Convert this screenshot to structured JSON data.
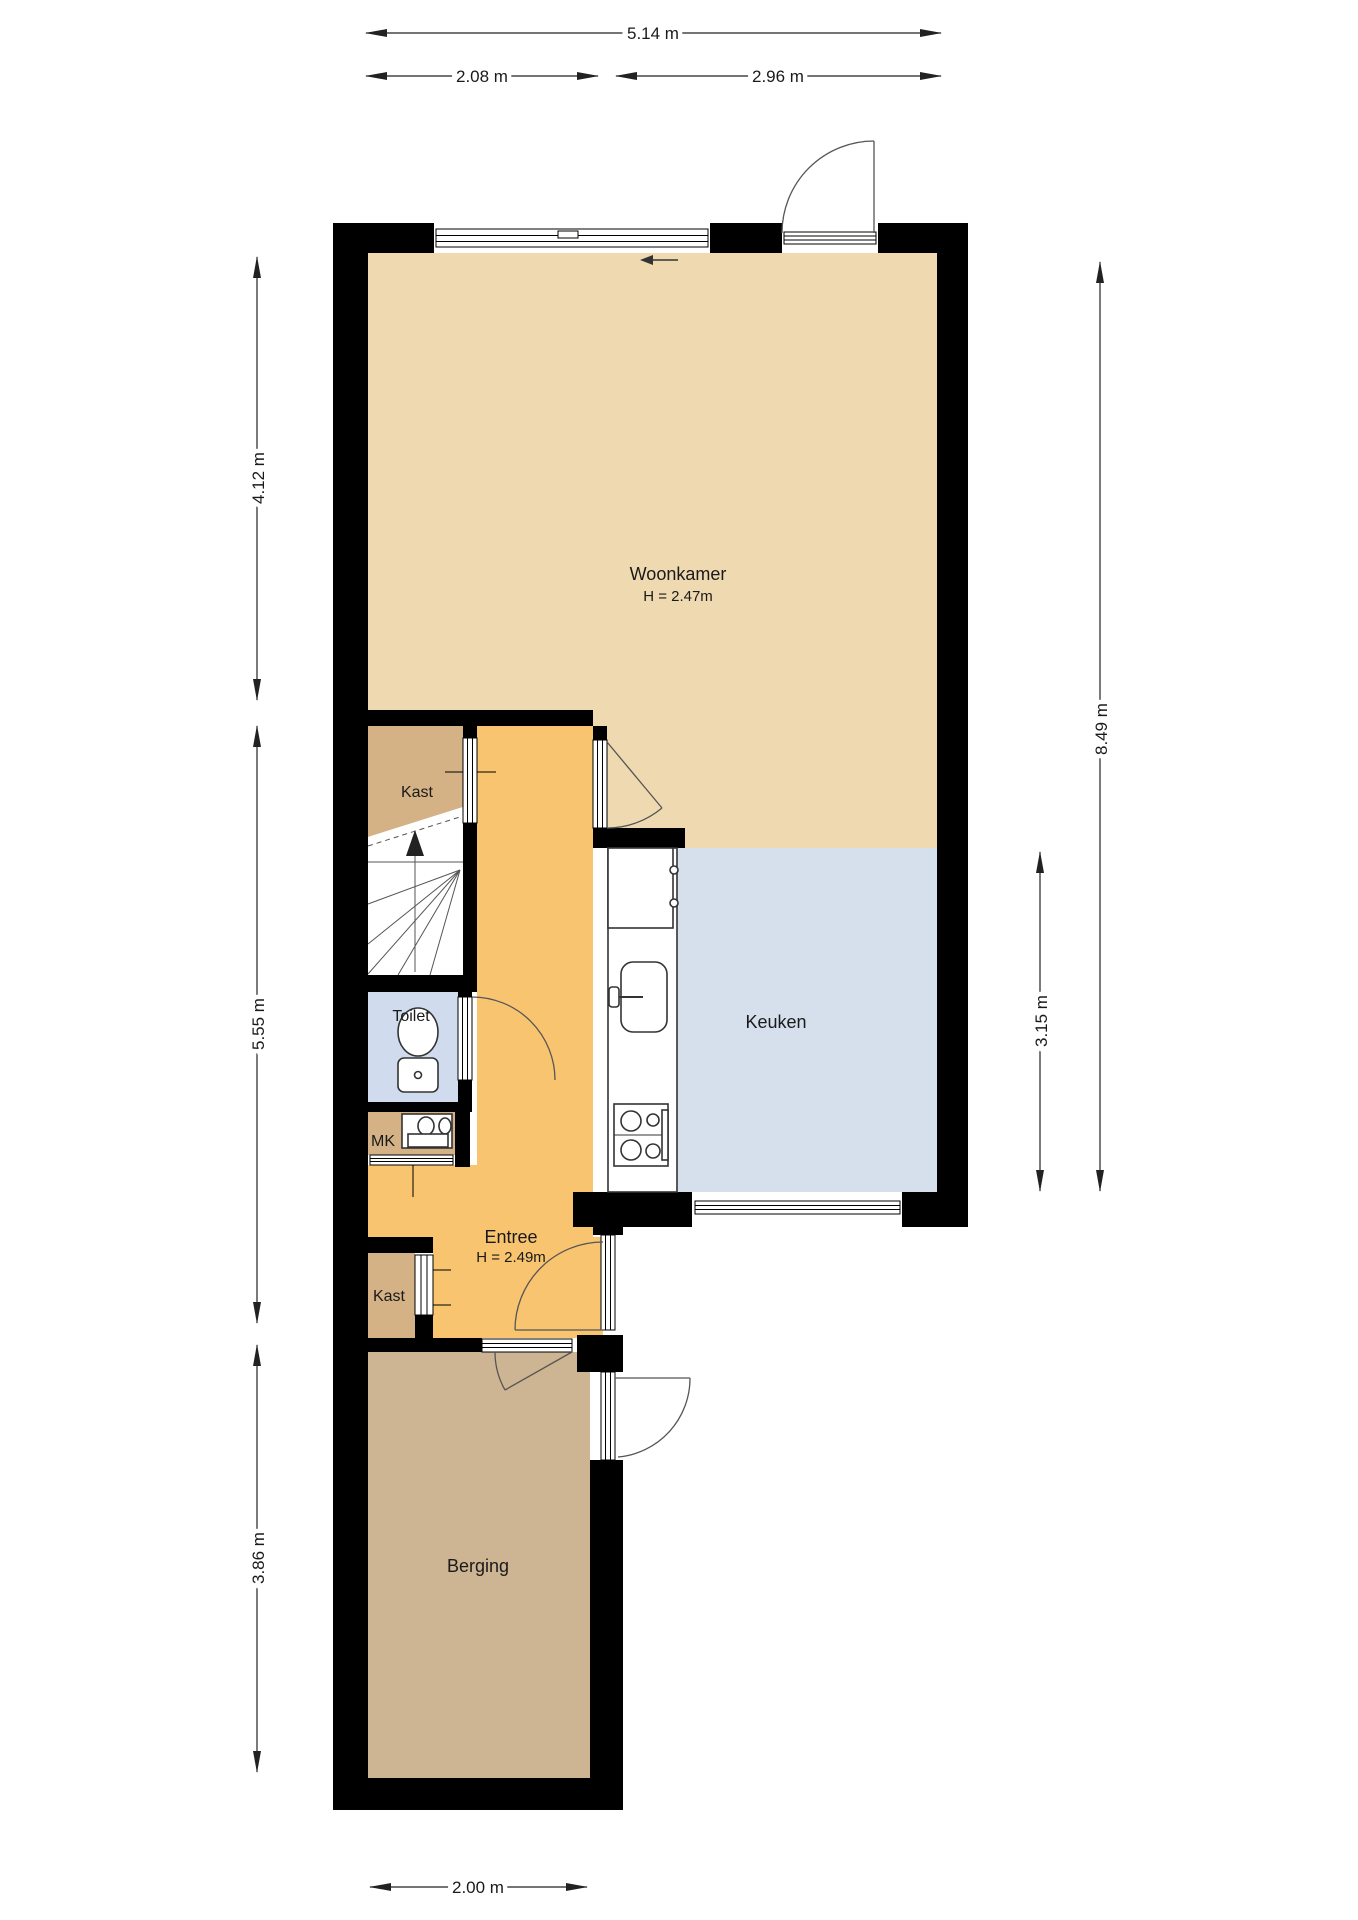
{
  "plan": {
    "type": "floorplan-ground-floor"
  },
  "colors": {
    "wall": "#000000",
    "woonkamer": "#efd9b0",
    "keuken": "#d5e0ec",
    "toilet": "#d0dcee",
    "entree": "#f8c470",
    "kast": "#d4b286",
    "berging": "#cdb493",
    "stairs": "#ffffff",
    "background": "#ffffff"
  },
  "rooms": {
    "woonkamer": {
      "name": "Woonkamer",
      "ceiling": "H = 2.47m"
    },
    "keuken": {
      "name": "Keuken"
    },
    "entree": {
      "name": "Entree",
      "ceiling": "H = 2.49m"
    },
    "toilet": {
      "name": "Toilet"
    },
    "mk": {
      "name": "MK"
    },
    "kast_upper": {
      "name": "Kast"
    },
    "kast_lower": {
      "name": "Kast"
    },
    "berging": {
      "name": "Berging"
    }
  },
  "dimensions": {
    "top_total": "5.14 m",
    "top_left": "2.08 m",
    "top_right": "2.96 m",
    "left_top": "4.12 m",
    "left_middle": "5.55 m",
    "left_bottom": "3.86 m",
    "right_total": "8.49 m",
    "right_kitchen": "3.15 m",
    "bottom": "2.00 m"
  }
}
